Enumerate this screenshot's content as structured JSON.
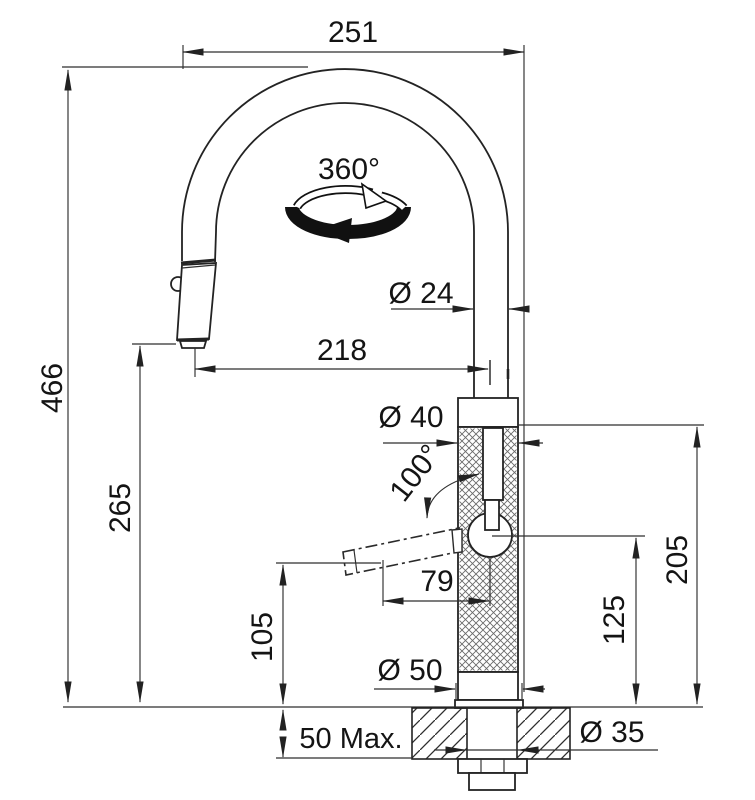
{
  "drawing": {
    "type": "technical-dimension-drawing",
    "subject": "pull-down kitchen faucet side elevation with countertop cross-section",
    "dimensions": {
      "spout_width_top": "251",
      "overall_height": "466",
      "spout_height": "265",
      "spout_reach": "218",
      "spout_tube_diameter": "Ø 24",
      "body_diameter": "Ø 40",
      "lever_projection": "79",
      "body_height_above_deck": "205",
      "lever_pivot_height": "125",
      "lever_clearance_height": "105",
      "base_diameter": "Ø 50",
      "max_deck_thickness": "50 Max.",
      "mounting_hole_diameter": "Ø 35"
    },
    "annotations": {
      "swivel_range": "360°",
      "lever_swing_angle": "100°"
    },
    "colors": {
      "line": "#2b2b2b",
      "text": "#141414",
      "background": "#ffffff"
    }
  }
}
